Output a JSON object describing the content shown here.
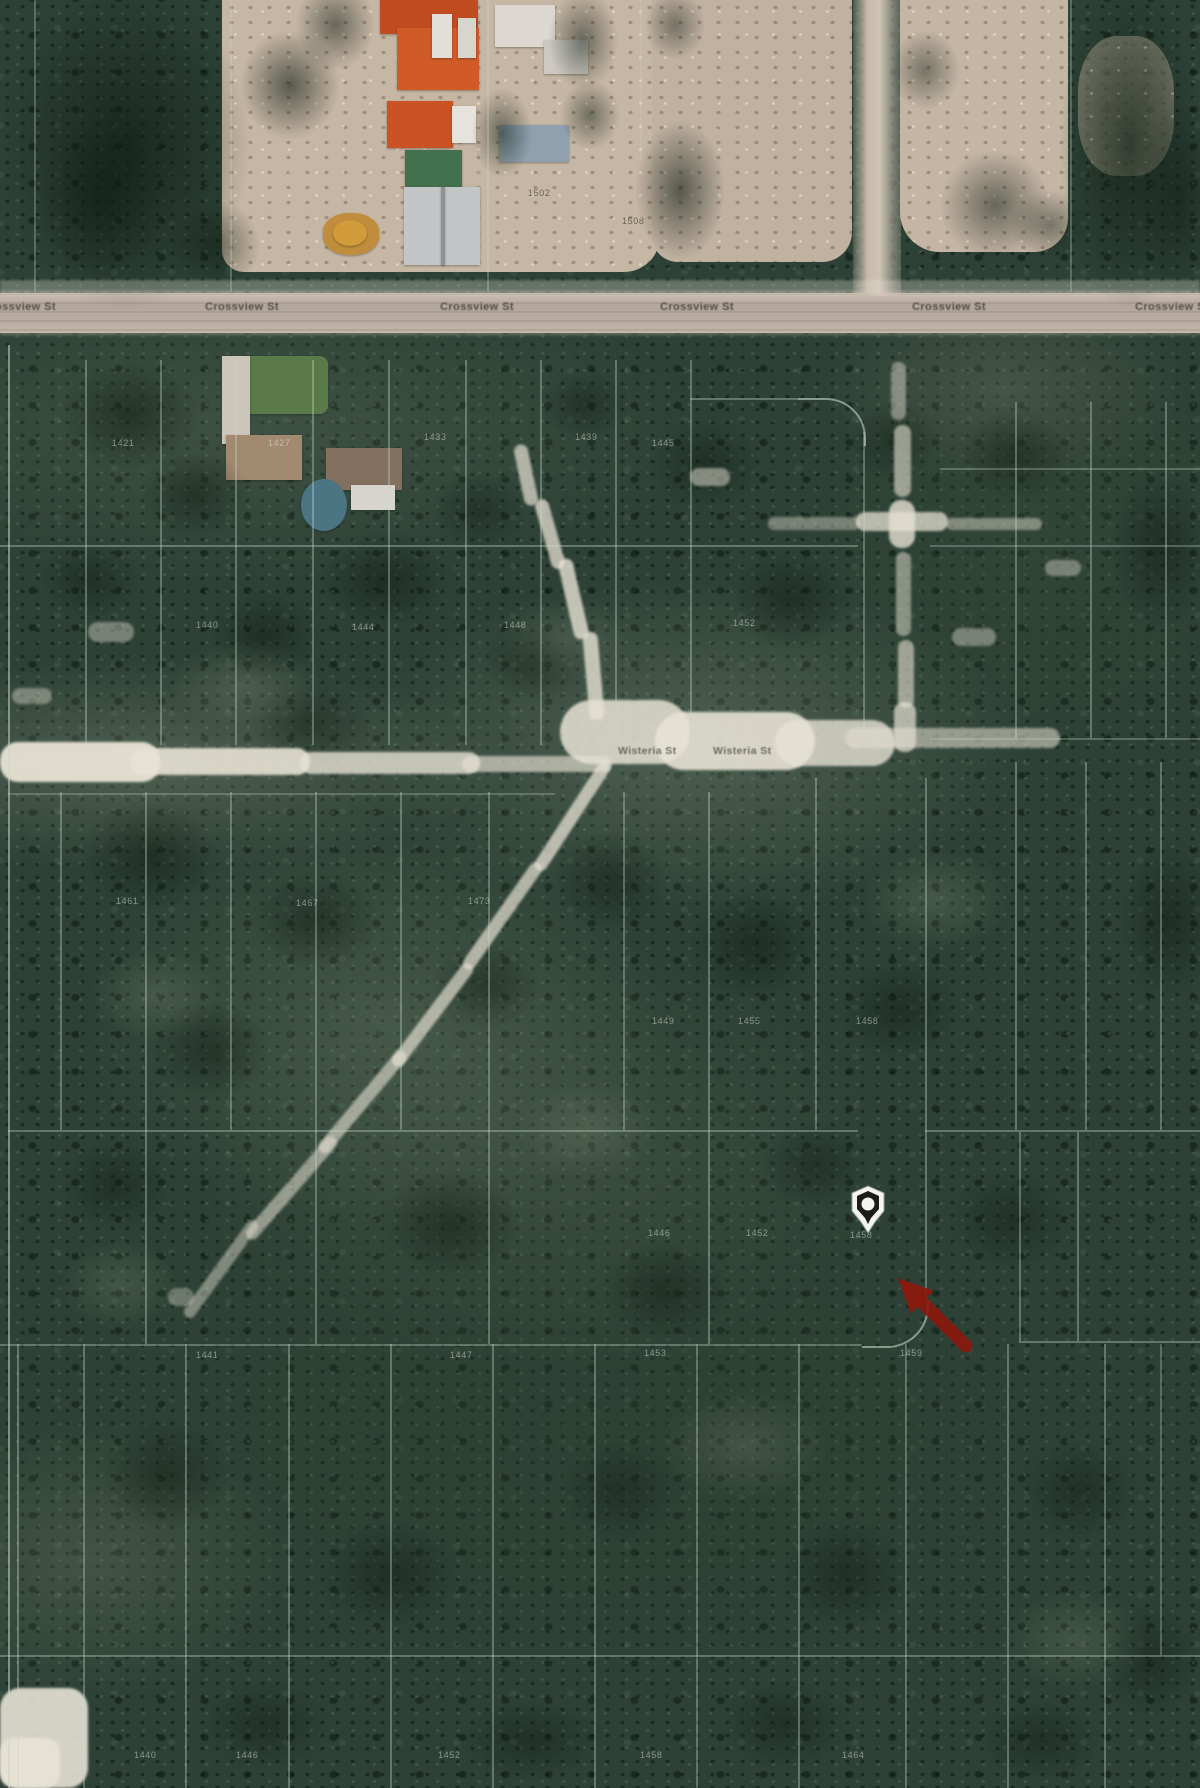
{
  "map_title": "Aerial parcel map with property location",
  "streets": {
    "crossview": {
      "name": "Crossview St",
      "labels": [
        {
          "x": -18,
          "y": 301
        },
        {
          "x": 205,
          "y": 301
        },
        {
          "x": 440,
          "y": 301
        },
        {
          "x": 660,
          "y": 301
        },
        {
          "x": 912,
          "y": 301
        },
        {
          "x": 1135,
          "y": 301
        }
      ]
    },
    "wisteria": {
      "name": "Wisteria St",
      "labels": [
        {
          "x": 618,
          "y": 745
        },
        {
          "x": 713,
          "y": 745
        }
      ]
    }
  },
  "marker": {
    "x": 868,
    "y": 1206
  },
  "arrow": {
    "color": "#8c190c",
    "tip": {
      "x": 898,
      "y": 1278
    },
    "tail": {
      "x": 966,
      "y": 1346
    }
  },
  "parcel_numbers": [
    {
      "text": "1502",
      "x": 528,
      "y": 188,
      "tone": "dark"
    },
    {
      "text": "1508",
      "x": 622,
      "y": 216,
      "tone": "dark"
    },
    {
      "text": "1514",
      "x": 1086,
      "y": 168,
      "tone": "dark"
    },
    {
      "text": "1421",
      "x": 112,
      "y": 438
    },
    {
      "text": "1427",
      "x": 268,
      "y": 438
    },
    {
      "text": "1433",
      "x": 424,
      "y": 432
    },
    {
      "text": "1439",
      "x": 575,
      "y": 432
    },
    {
      "text": "1445",
      "x": 652,
      "y": 438
    },
    {
      "text": "1440",
      "x": 196,
      "y": 620
    },
    {
      "text": "1444",
      "x": 352,
      "y": 622
    },
    {
      "text": "1448",
      "x": 504,
      "y": 620
    },
    {
      "text": "1452",
      "x": 733,
      "y": 618
    },
    {
      "text": "1461",
      "x": 116,
      "y": 896
    },
    {
      "text": "1467",
      "x": 296,
      "y": 898
    },
    {
      "text": "1473",
      "x": 468,
      "y": 896
    },
    {
      "text": "1449",
      "x": 652,
      "y": 1016
    },
    {
      "text": "1455",
      "x": 738,
      "y": 1016
    },
    {
      "text": "1458",
      "x": 856,
      "y": 1016
    },
    {
      "text": "1446",
      "x": 648,
      "y": 1228
    },
    {
      "text": "1452",
      "x": 746,
      "y": 1228
    },
    {
      "text": "1458",
      "x": 850,
      "y": 1230
    },
    {
      "text": "1441",
      "x": 196,
      "y": 1350
    },
    {
      "text": "1447",
      "x": 450,
      "y": 1350
    },
    {
      "text": "1453",
      "x": 644,
      "y": 1348
    },
    {
      "text": "1459",
      "x": 900,
      "y": 1348
    },
    {
      "text": "1434",
      "x": 24,
      "y": 1750
    },
    {
      "text": "1440",
      "x": 134,
      "y": 1750
    },
    {
      "text": "1446",
      "x": 236,
      "y": 1750
    },
    {
      "text": "1452",
      "x": 438,
      "y": 1750
    },
    {
      "text": "1458",
      "x": 640,
      "y": 1750
    },
    {
      "text": "1464",
      "x": 842,
      "y": 1750
    }
  ],
  "colors": {
    "forest_green": "#2d4136",
    "road_gray": "#b7aa9d",
    "trail_white": "#e7e2d4",
    "parcel_line": "#c6d8cc",
    "roof_orange": "#d05a28",
    "roof_green": "#43704d",
    "marker_fill": "#f4f4f0",
    "marker_inner": "#1b1b17",
    "arrow_red": "#8c190c"
  }
}
